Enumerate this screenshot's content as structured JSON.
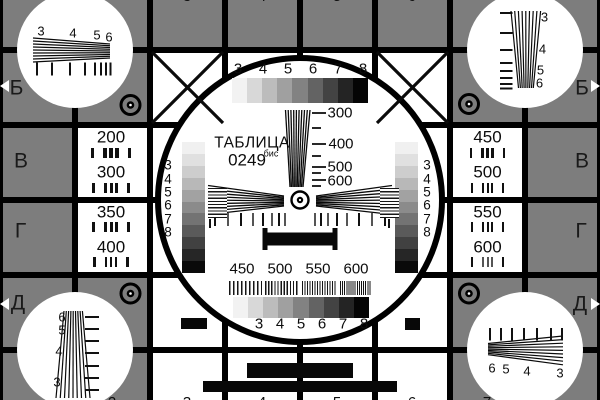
{
  "title": {
    "name": "ТАБЛИЦА",
    "number": "0249",
    "suffix": "бис"
  },
  "row_letters": {
    "left": [
      "Б",
      "В",
      "Г",
      "Д"
    ],
    "right": [
      "Б",
      "В",
      "Г",
      "Д"
    ]
  },
  "top_scale_digits": [
    "3",
    "4",
    "5",
    "6",
    "7",
    "8"
  ],
  "bottom_scale_digits": [
    "3",
    "4",
    "5",
    "6",
    "7",
    "8"
  ],
  "vertical_wedge_labels": [
    "300",
    "400",
    "500",
    "600"
  ],
  "freq_bar_labels": [
    "450",
    "500",
    "550",
    "600"
  ],
  "left_bar_digits": [
    "3",
    "4",
    "5",
    "6",
    "7",
    "8"
  ],
  "right_bar_digits": [
    "3",
    "4",
    "5",
    "6",
    "7",
    "8"
  ],
  "cells": {
    "left_top": [
      "200",
      "300"
    ],
    "left_bottom": [
      "350",
      "400"
    ],
    "right_top": [
      "450",
      "500"
    ],
    "right_bottom": [
      "550",
      "600"
    ]
  },
  "corners": {
    "top_left": [
      "3",
      "4",
      "5",
      "6"
    ],
    "top_right": [
      "3",
      "4",
      "5",
      "6"
    ],
    "bottom_left": [
      "6",
      "5",
      "4",
      "3"
    ],
    "bottom_right": [
      "6",
      "5",
      "4",
      "3"
    ]
  },
  "edge_digits_top": [
    "3",
    "4",
    "5",
    "6"
  ],
  "edge_digits_bottom": [
    "2",
    "3",
    "4",
    "5",
    "6",
    "7"
  ],
  "colors": {
    "background": "#7d7d7d",
    "line": "#000000",
    "white": "#ffffff",
    "ink": "#0c0c0c"
  },
  "grayscale_h": [
    "#f2f2f2",
    "#d8d8d8",
    "#bcbcbc",
    "#a0a0a0",
    "#828282",
    "#636363",
    "#434343",
    "#242424",
    "#050505"
  ],
  "grayscale_v": [
    "#f0f0f0",
    "#e0e0e0",
    "#cdcdcd",
    "#b8b8b8",
    "#a2a2a2",
    "#8b8b8b",
    "#737373",
    "#5a5a5a",
    "#414141",
    "#262626",
    "#0a0a0a"
  ]
}
